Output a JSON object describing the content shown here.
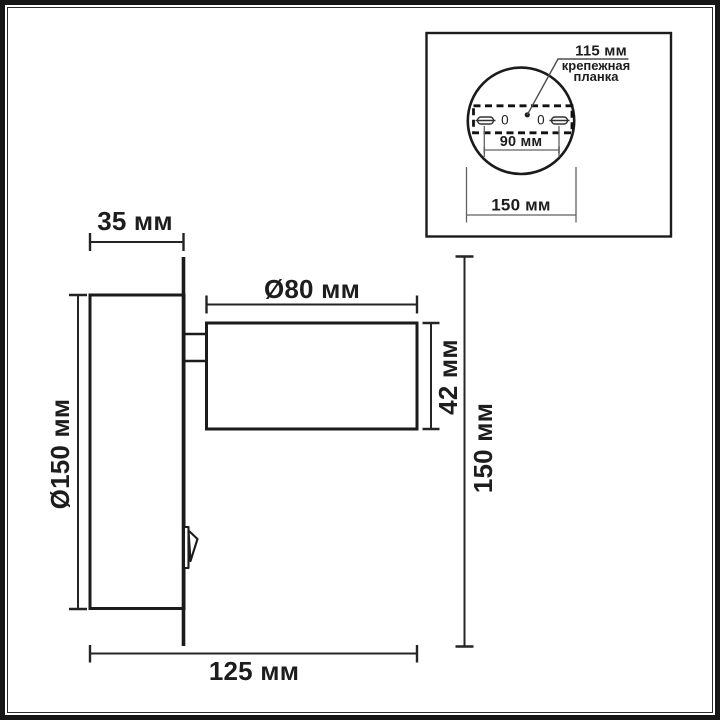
{
  "colors": {
    "line": "#1b1b1b",
    "dimension_line": "#242424",
    "thin_line": "#5f5f5f",
    "background": "#ffffff"
  },
  "main_view": {
    "dim_backplate_depth": "35 мм",
    "dim_head_diameter": "Ø80 мм",
    "dim_head_length": "42 мм",
    "dim_backplate_diameter": "Ø150 мм",
    "dim_overall_height": "150 мм",
    "dim_overall_depth": "125 мм"
  },
  "inset_view": {
    "dim_mount_plate_width": "115 мм",
    "mount_plate_note_line1": "крепежная",
    "mount_plate_note_line2": "планка",
    "dim_hole_spacing": "90 мм",
    "dim_plate_diameter": "150 мм",
    "hole_mark_left": "0",
    "hole_mark_right": "0"
  }
}
